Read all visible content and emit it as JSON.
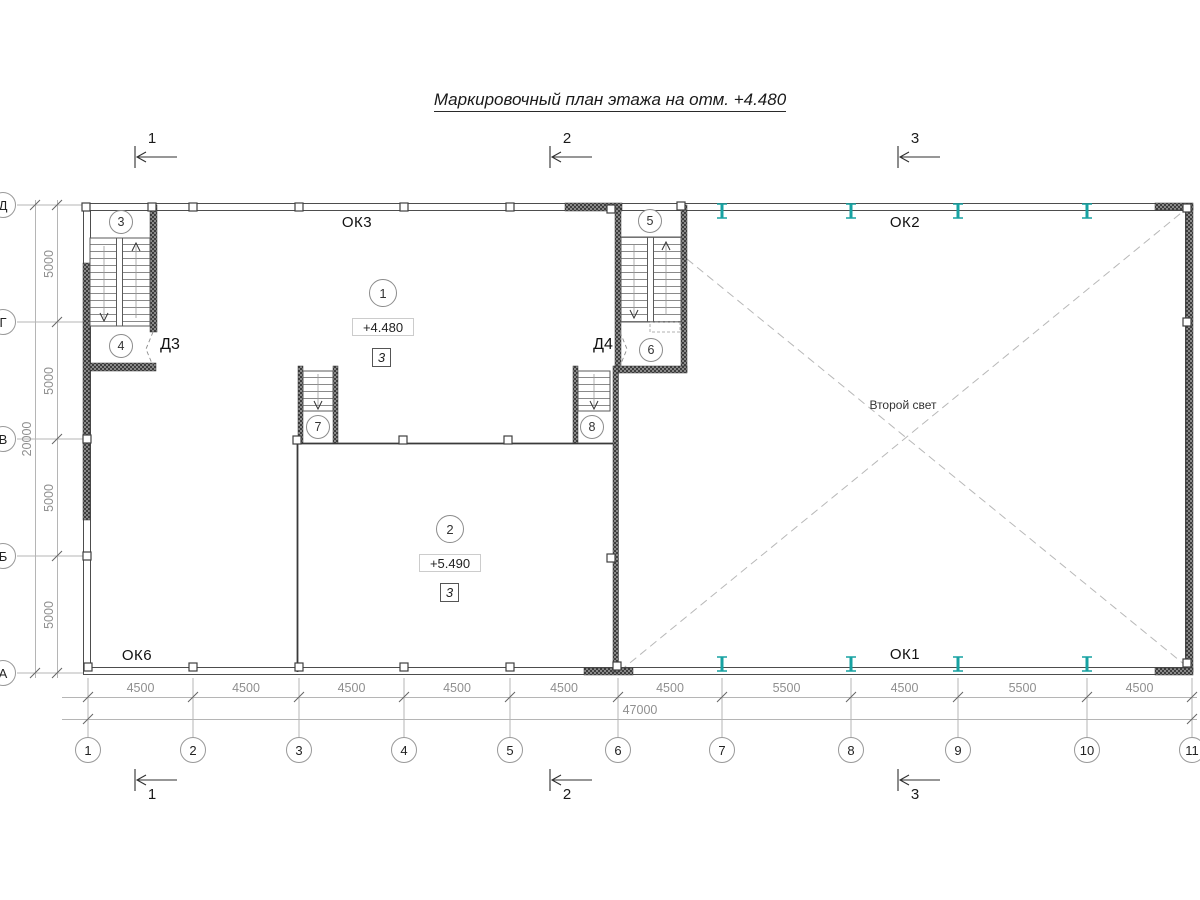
{
  "title": "Маркировочный план этажа на отм. +4.480",
  "grid": {
    "columns": [
      {
        "label": "1",
        "x": 88
      },
      {
        "label": "2",
        "x": 193
      },
      {
        "label": "3",
        "x": 299
      },
      {
        "label": "4",
        "x": 404
      },
      {
        "label": "5",
        "x": 510
      },
      {
        "label": "6",
        "x": 618
      },
      {
        "label": "7",
        "x": 722
      },
      {
        "label": "8",
        "x": 851
      },
      {
        "label": "9",
        "x": 958
      },
      {
        "label": "10",
        "x": 1087
      },
      {
        "label": "11",
        "x": 1192
      }
    ],
    "rows": [
      {
        "label": "Д",
        "y": 205
      },
      {
        "label": "Г",
        "y": 322
      },
      {
        "label": "В",
        "y": 439
      },
      {
        "label": "Б",
        "y": 556
      },
      {
        "label": "А",
        "y": 673
      }
    ]
  },
  "dimensions": {
    "bottom_segments": [
      "4500",
      "4500",
      "4500",
      "4500",
      "4500",
      "4500",
      "5500",
      "4500",
      "5500",
      "4500"
    ],
    "bottom_total": "47000",
    "left_segments": [
      "5000",
      "5000",
      "5000",
      "5000"
    ],
    "left_total": "20000"
  },
  "sections": [
    {
      "label": "1",
      "x": 135
    },
    {
      "label": "2",
      "x": 550
    },
    {
      "label": "3",
      "x": 898
    }
  ],
  "rooms": [
    {
      "number": "1",
      "elevation": "+4.480",
      "type_mark": "3"
    },
    {
      "number": "2",
      "elevation": "+5.490",
      "type_mark": "3"
    }
  ],
  "stair_markers": [
    {
      "label": "3",
      "x": 121,
      "y": 222
    },
    {
      "label": "4",
      "x": 121,
      "y": 346
    },
    {
      "label": "5",
      "x": 650,
      "y": 221
    },
    {
      "label": "6",
      "x": 651,
      "y": 350
    },
    {
      "label": "7",
      "x": 318,
      "y": 427
    },
    {
      "label": "8",
      "x": 592,
      "y": 427
    }
  ],
  "window_labels": [
    {
      "text": "ОК3",
      "x": 357,
      "y": 224
    },
    {
      "text": "ОК2",
      "x": 905,
      "y": 224
    },
    {
      "text": "ОК6",
      "x": 137,
      "y": 657
    },
    {
      "text": "ОК1",
      "x": 905,
      "y": 656
    }
  ],
  "door_labels": [
    {
      "text": "Д3",
      "x": 170,
      "y": 347
    },
    {
      "text": "Д4",
      "x": 603,
      "y": 347
    }
  ],
  "labels": {
    "second_light": "Второй свет"
  },
  "colors": {
    "steel_column": "#17a2a2",
    "grid_line": "#b5b5b5",
    "wall": "#4d4d4d",
    "dim_text": "#8f8f8f"
  }
}
